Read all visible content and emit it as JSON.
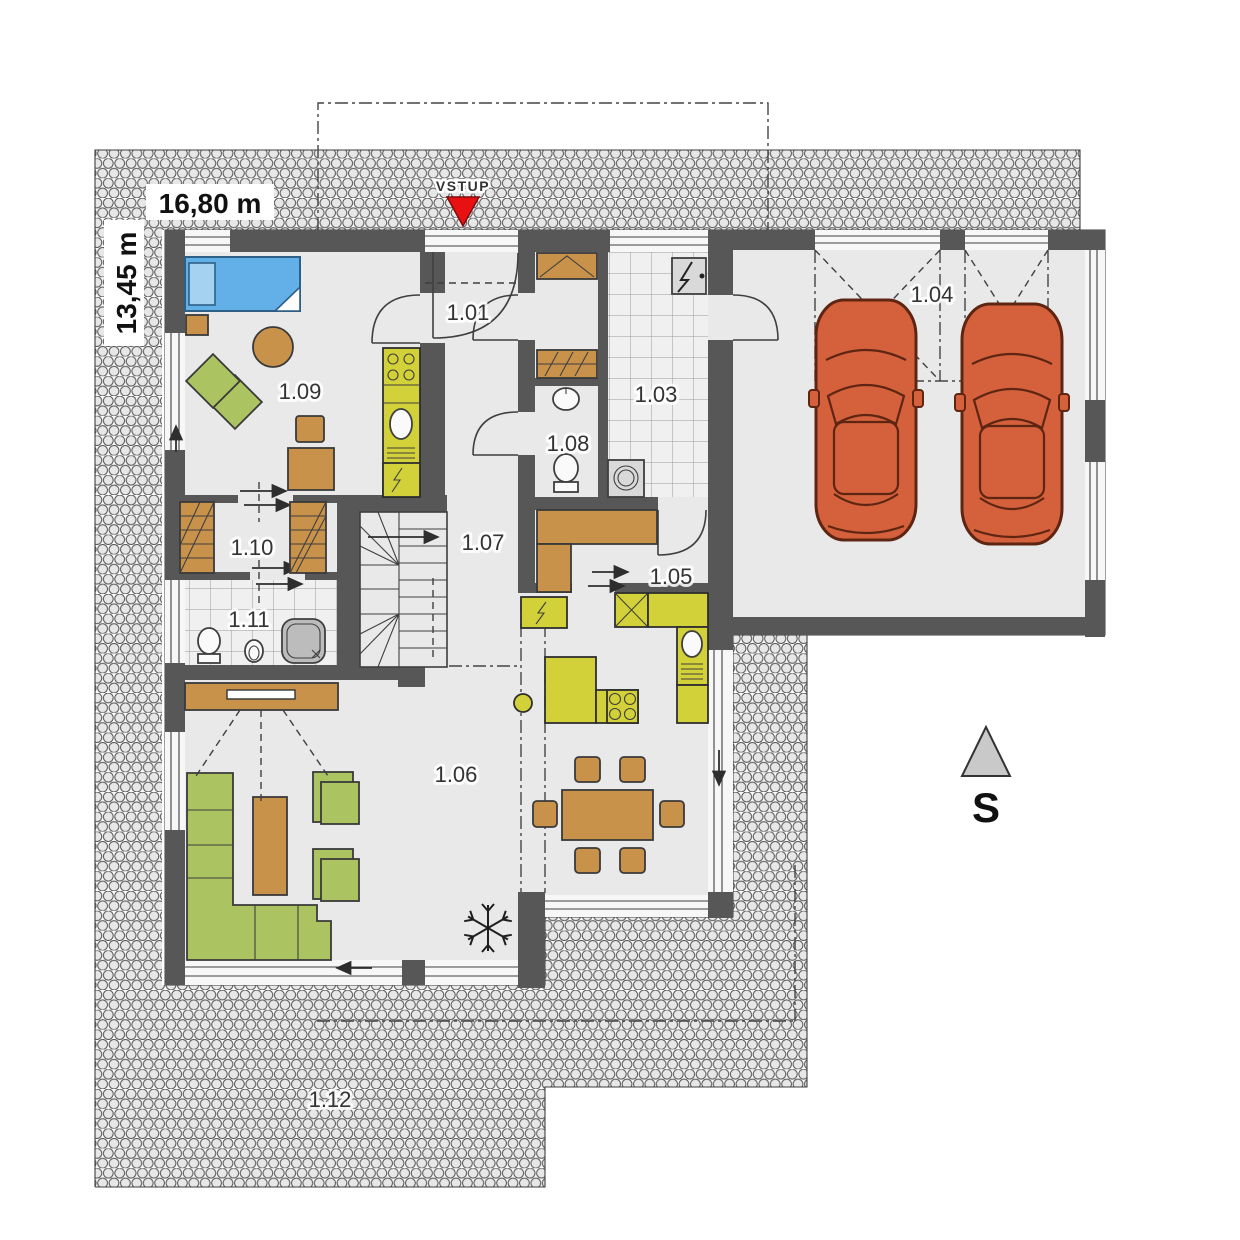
{
  "plan": {
    "dimensions": {
      "width_label": "16,80 m",
      "height_label": "13,45 m"
    },
    "entrance": {
      "label": "VSTUP"
    },
    "compass": {
      "label": "S"
    },
    "rooms": [
      {
        "number": "1.01"
      },
      {
        "number": "1.03"
      },
      {
        "number": "1.04"
      },
      {
        "number": "1.05"
      },
      {
        "number": "1.06"
      },
      {
        "number": "1.07"
      },
      {
        "number": "1.08"
      },
      {
        "number": "1.09"
      },
      {
        "number": "1.10"
      },
      {
        "number": "1.11"
      },
      {
        "number": "1.12"
      }
    ],
    "colors": {
      "wall": "#575757",
      "floor": "#e9e9e9",
      "wood": "#c9924b",
      "green": "#abc360",
      "kitchen": "#d3d139",
      "car": "#d4613c",
      "bed": "#63b0e8",
      "pillow": "#a5d2f0",
      "red": "#e81111",
      "shower": "#bcbcbc",
      "compass": "#c9c9c9"
    }
  }
}
